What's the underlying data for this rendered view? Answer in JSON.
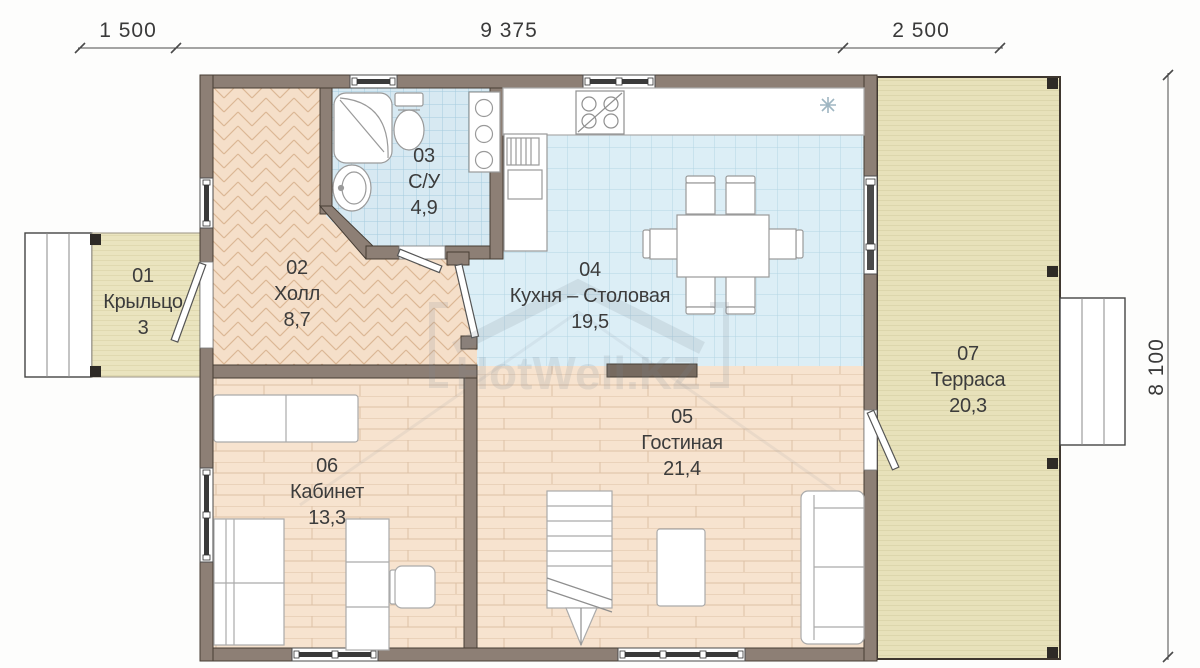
{
  "watermark": {
    "text": "HotWell.KZ"
  },
  "dimensions": {
    "top": [
      {
        "label": "1 500"
      },
      {
        "label": "9 375"
      },
      {
        "label": "2 500"
      }
    ],
    "right": {
      "label": "8 100"
    }
  },
  "rooms": [
    {
      "number": "01",
      "name": "Крыльцо",
      "area": "3"
    },
    {
      "number": "02",
      "name": "Холл",
      "area": "8,7"
    },
    {
      "number": "03",
      "name": "С/У",
      "area": "4,9"
    },
    {
      "number": "04",
      "name": "Кухня – Столовая",
      "area": "19,5"
    },
    {
      "number": "05",
      "name": "Гостиная",
      "area": "21,4"
    },
    {
      "number": "06",
      "name": "Кабинет",
      "area": "13,3"
    },
    {
      "number": "07",
      "name": "Терраса",
      "area": "20,3"
    }
  ],
  "icons": {
    "snowflake": "ventilation-snowflake",
    "shower": "shower-cabin",
    "toilet": "toilet",
    "sink": "washbasin",
    "stove": "cooktop-4-burners"
  },
  "colors": {
    "wall": "#8d7f75",
    "wall_edge": "#463d34",
    "wall_stub": "#776a5f",
    "bath_tile": "#d7e9f2",
    "bath_tile_line": "#a6ccdd",
    "kitchen_tile": "#dceef6",
    "kitchen_tile_line": "#b4d5e4",
    "wood": "#f7e3cf",
    "wood_line": "#dcc0a5",
    "parquet": "#f5dfc9",
    "parquet_line": "#dcb795",
    "deck": "#eae4bf",
    "deck_line": "#d5cea2",
    "furniture_stroke": "#9a9a9a",
    "text": "#3c3c3c",
    "dimension": "#4a4a4a",
    "watermark": "#7c8894"
  }
}
